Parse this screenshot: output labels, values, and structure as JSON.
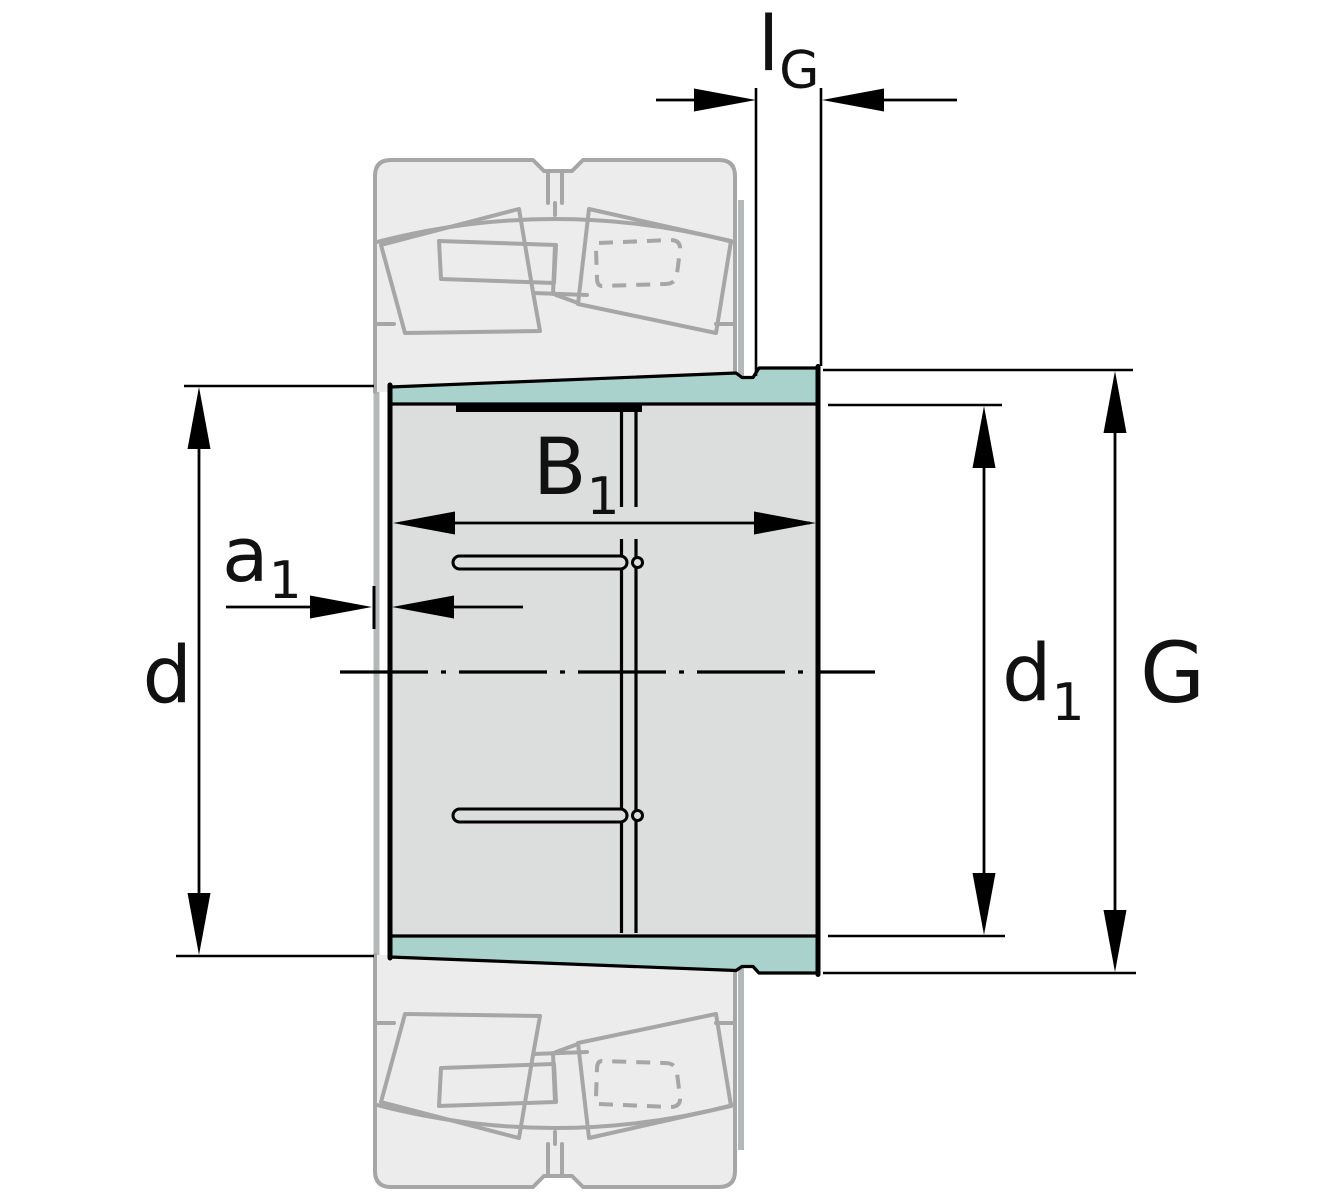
{
  "diagram": {
    "kind": "adapter-sleeve-cross-section-technical-drawing",
    "labels": {
      "lG": {
        "base": "l",
        "sub": "G"
      },
      "B1": {
        "base": "B",
        "sub": "1"
      },
      "a1": {
        "base": "a",
        "sub": "1"
      },
      "d": {
        "base": "d"
      },
      "d1": {
        "base": "d",
        "sub": "1"
      },
      "G": {
        "base": "G"
      }
    },
    "colors": {
      "sleeve_fill": "#dcdddd",
      "taper_highlight": "#aad2cd",
      "ghost_fill": "#ececec",
      "ghost_stroke": "#a6a6a6",
      "connector_stroke": "#b5b8b8",
      "line": "#000000",
      "label": "#111111"
    }
  }
}
